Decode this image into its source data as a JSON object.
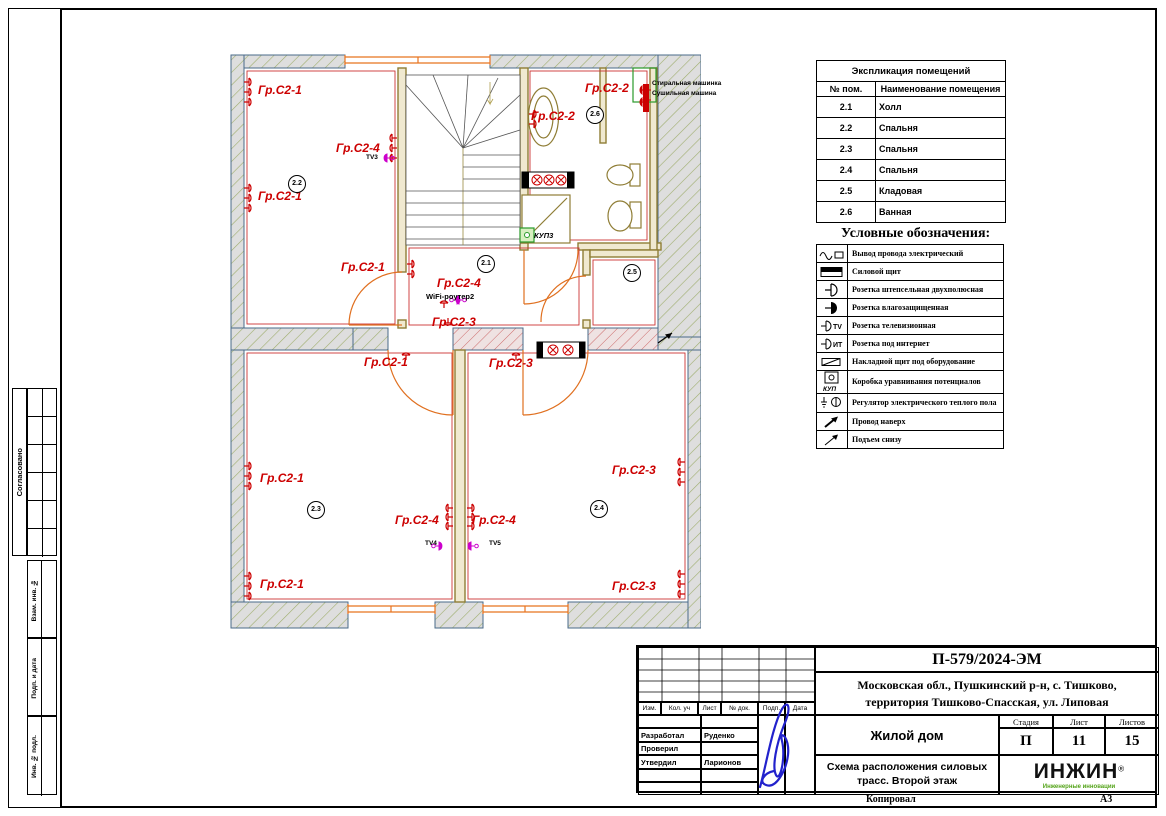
{
  "frame": {
    "copied": "Копировал",
    "format": "А3"
  },
  "margin": {
    "agreed": "Согласовано",
    "vzam": "Взам. инв. №",
    "podp_data": "Подп. и дата",
    "inv_podl": "Инв. № подл."
  },
  "explication": {
    "title": "Экспликация помещений",
    "col_num": "№ пом.",
    "col_name": "Наименование помещения",
    "rows": [
      {
        "num": "2.1",
        "name": "Холл"
      },
      {
        "num": "2.2",
        "name": "Спальня"
      },
      {
        "num": "2.3",
        "name": "Спальня"
      },
      {
        "num": "2.4",
        "name": "Спальня"
      },
      {
        "num": "2.5",
        "name": "Кладовая"
      },
      {
        "num": "2.6",
        "name": "Ванная"
      }
    ]
  },
  "legend": {
    "title": "Условные обозначения:",
    "icon_tv": "ТV",
    "icon_it": "ИТ",
    "icon_kup": "КУП",
    "items": [
      "Вывод провода электрический",
      "Силовой щит",
      "Розетка штепсельная двухполюсная",
      "Розетка влагозащищенная",
      "Розетка телевизионная",
      "Розетка под интернет",
      "Накладной щит под оборудование",
      "Коробка уравнивания потенциалов",
      "Регулятор электрического теплого пола",
      "Провод наверх",
      "Подъем снизу"
    ]
  },
  "plan": {
    "g1": "Гр.С2-1",
    "g2": "Гр.С2-2",
    "g3": "Гр.С2-3",
    "g4": "Гр.С2-4",
    "tv3": "ТV3",
    "tv4": "ТV4",
    "tv5": "ТV5",
    "wifi": "WiFi-роутер2",
    "kup3": "КУП3",
    "washer": "Стиральная машинка",
    "dryer": "Сушильная машина",
    "rooms": {
      "hall": "2.1",
      "bed1": "2.2",
      "bed2": "2.3",
      "bed3": "2.4",
      "storage": "2.5",
      "bath": "2.6"
    }
  },
  "titleblock": {
    "doc_number": "П-579/2024-ЭМ",
    "address1": "Московская обл., Пушкинский р-н, с. Тишково,",
    "address2": "территория Тишково-Спасская, ул. Липовая",
    "object": "Жилой дом",
    "title1": "Схема расположения силовых",
    "title2": "трасс. Второй этаж",
    "stage_label": "Стадия",
    "list_label": "Лист",
    "lists_label": "Листов",
    "stage": "П",
    "list": "11",
    "lists": "15",
    "col_izm": "Изм.",
    "col_kol": "Кол. уч",
    "col_list": "Лист",
    "col_ndok": "№ док.",
    "col_podp": "Подп.",
    "col_data": "Дата",
    "role_dev": "Разработал",
    "name_dev": "Руденко",
    "role_check": "Проверил",
    "role_appr": "Утвердил",
    "name_appr": "Ларионов",
    "logo": "ИНЖИН",
    "logo_reg": "®",
    "logo_tagline": "Инженерные инновации"
  }
}
